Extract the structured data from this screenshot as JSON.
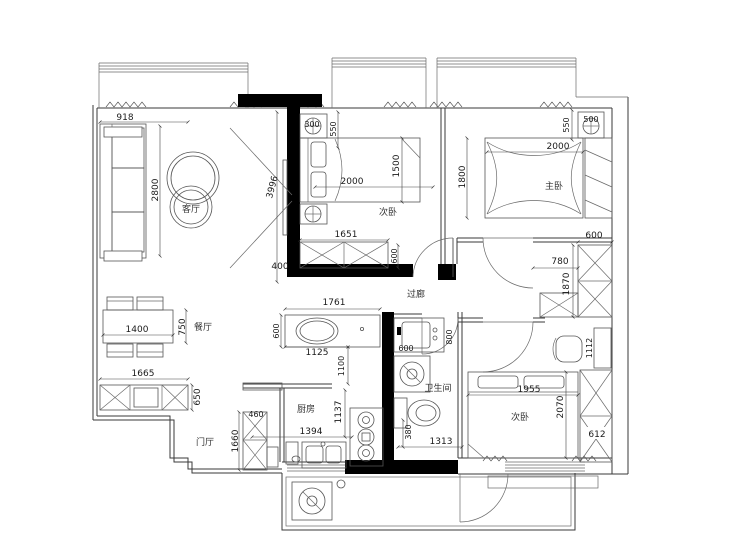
{
  "rooms": {
    "living": "客厅",
    "bed1": "次卧",
    "master": "主卧",
    "hall": "过廊",
    "dining": "餐厅",
    "entry": "门厅",
    "kitchen": "厨房",
    "bath": "卫生间",
    "bed3": "次卧"
  },
  "dims": {
    "living_width": "918",
    "sofa_wall": "2800",
    "living_length": "3996",
    "wall_offset": "400",
    "b1_niche": "300",
    "b1_nightstand": "550",
    "b1_bed_len": "2000",
    "b1_bed_wid": "1500",
    "b1_wardrobe": "1651",
    "b1_door": "600",
    "m_nightstand_w": "500",
    "m_nightstand": "550",
    "m_bed_len": "2000",
    "m_bed_wid": "1800",
    "m_closet_w": "600",
    "m_closet_off": "780",
    "m_closet_h": "1870",
    "hall_len": "1761",
    "hall_counter": "600",
    "hall_basin": "1125",
    "hall_pass": "1100",
    "bath_sink_w": "600",
    "bath_sink_l": "800",
    "bath_toilet": "380",
    "bath_width": "1313",
    "din_table_l": "1400",
    "din_table_w": "750",
    "din_cab_l": "1665",
    "din_cab_w": "650",
    "ent_cab_w": "460",
    "ent_cab_h": "1660",
    "kit_counter": "1394",
    "kit_depth": "1137",
    "b3_bed_l": "1955",
    "b3_bed_w": "2070",
    "b3_wardrobe": "612",
    "b3_desk": "1112"
  }
}
